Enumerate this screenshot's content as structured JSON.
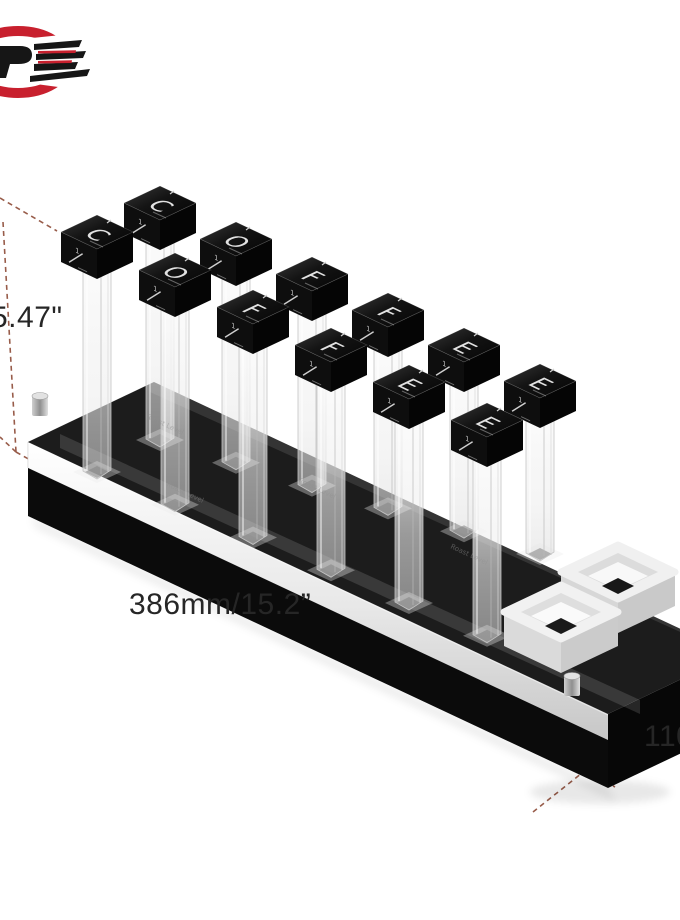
{
  "page": {
    "background": "#ffffff",
    "kind": "product dimension photo"
  },
  "logo": {
    "label": "brand emblem",
    "red": "#c8202e",
    "black": "#161616"
  },
  "dimensions": {
    "height_label": "5.47\"",
    "length_label": "386mm/15.2”",
    "depth_label": "110",
    "line_color": "#8d4b37"
  },
  "product": {
    "word": "COFFEE",
    "letters_back": [
      "C",
      "O",
      "F",
      "F",
      "E",
      "E"
    ],
    "letters_front": [
      "C",
      "O",
      "F",
      "F",
      "E",
      "E"
    ],
    "cap_front_number": "1",
    "tube_label": "Roast Level",
    "tray_count": 2,
    "colors": {
      "cap": "#0d0d0d",
      "base": "#0b0b0b",
      "acrylic": "#ececec",
      "tray": "#f0f0f0"
    }
  }
}
